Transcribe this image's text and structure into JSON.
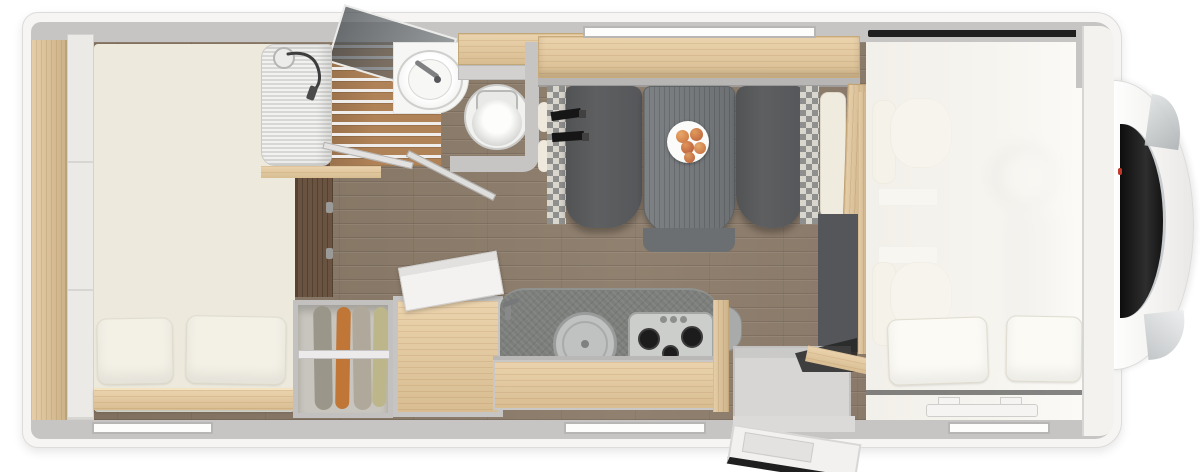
{
  "image_type": "motorhome-floorplan-top-view-3d-render",
  "labels": {
    "vehicle_body": "motorhome body shell",
    "cab_front": "cab front with windshield",
    "windshield": "windshield",
    "rear_bed": "rear french bed with two pillows",
    "rear_shelf": "rear wardrobe shelf",
    "bathroom": "bathroom",
    "shower": "shower with teak grate and glass screen",
    "shower_head": "hand shower on hose",
    "washbasin": "round washbasin with tap",
    "toilet": "toilet",
    "dinette": "dinette seating group",
    "overhead_locker": "overhead locker / shelf above dinette",
    "bench_left": "dinette bench with seat belts",
    "bench_right": "dinette bench",
    "table": "dinette table",
    "fruit_plate": "plate with fruit",
    "kitchen": "kitchen block",
    "sink": "round sink with cover",
    "hob": "3-burner gas hob",
    "worktop": "kitchen worktop",
    "fridge": "refrigerator cabinet with open lid",
    "wardrobe": "wardrobe with hanging clothes",
    "entry_door": "entry door (open)",
    "entry_step": "entrance step",
    "cab_seats": "cab swivel seats",
    "drop_down_bed": "drop-down bed over cab with two pillows",
    "window_top": "window",
    "window_bed": "bedroom window",
    "window_kitchen": "kitchen window",
    "window_front": "front side window",
    "partition_wall": "bedroom partition wall",
    "bifold_door": "folding bathroom door"
  },
  "palette": {
    "body_white": "#f6f5f3",
    "wall_gray": "#c6c5c3",
    "floor_wood": "#8a7a69",
    "cabinet_wood": "#e6c99b",
    "upholstery_cream": "#edeadd",
    "bench_gray": "#5a5b5d",
    "worktop_gray": "#7c7e7b",
    "windshield_black": "#1a1a1a",
    "fruit_orange": "#d0763f",
    "clothes_colors": [
      "#9b968a",
      "#bf7636",
      "#b0a99b",
      "#bcb68a"
    ]
  },
  "counts": {
    "hob_burners": 3,
    "dinette_benches": 2,
    "bed_pillows": 2,
    "dropdown_bed_pillows": 2,
    "hanging_garments": 4,
    "windows": 4
  }
}
